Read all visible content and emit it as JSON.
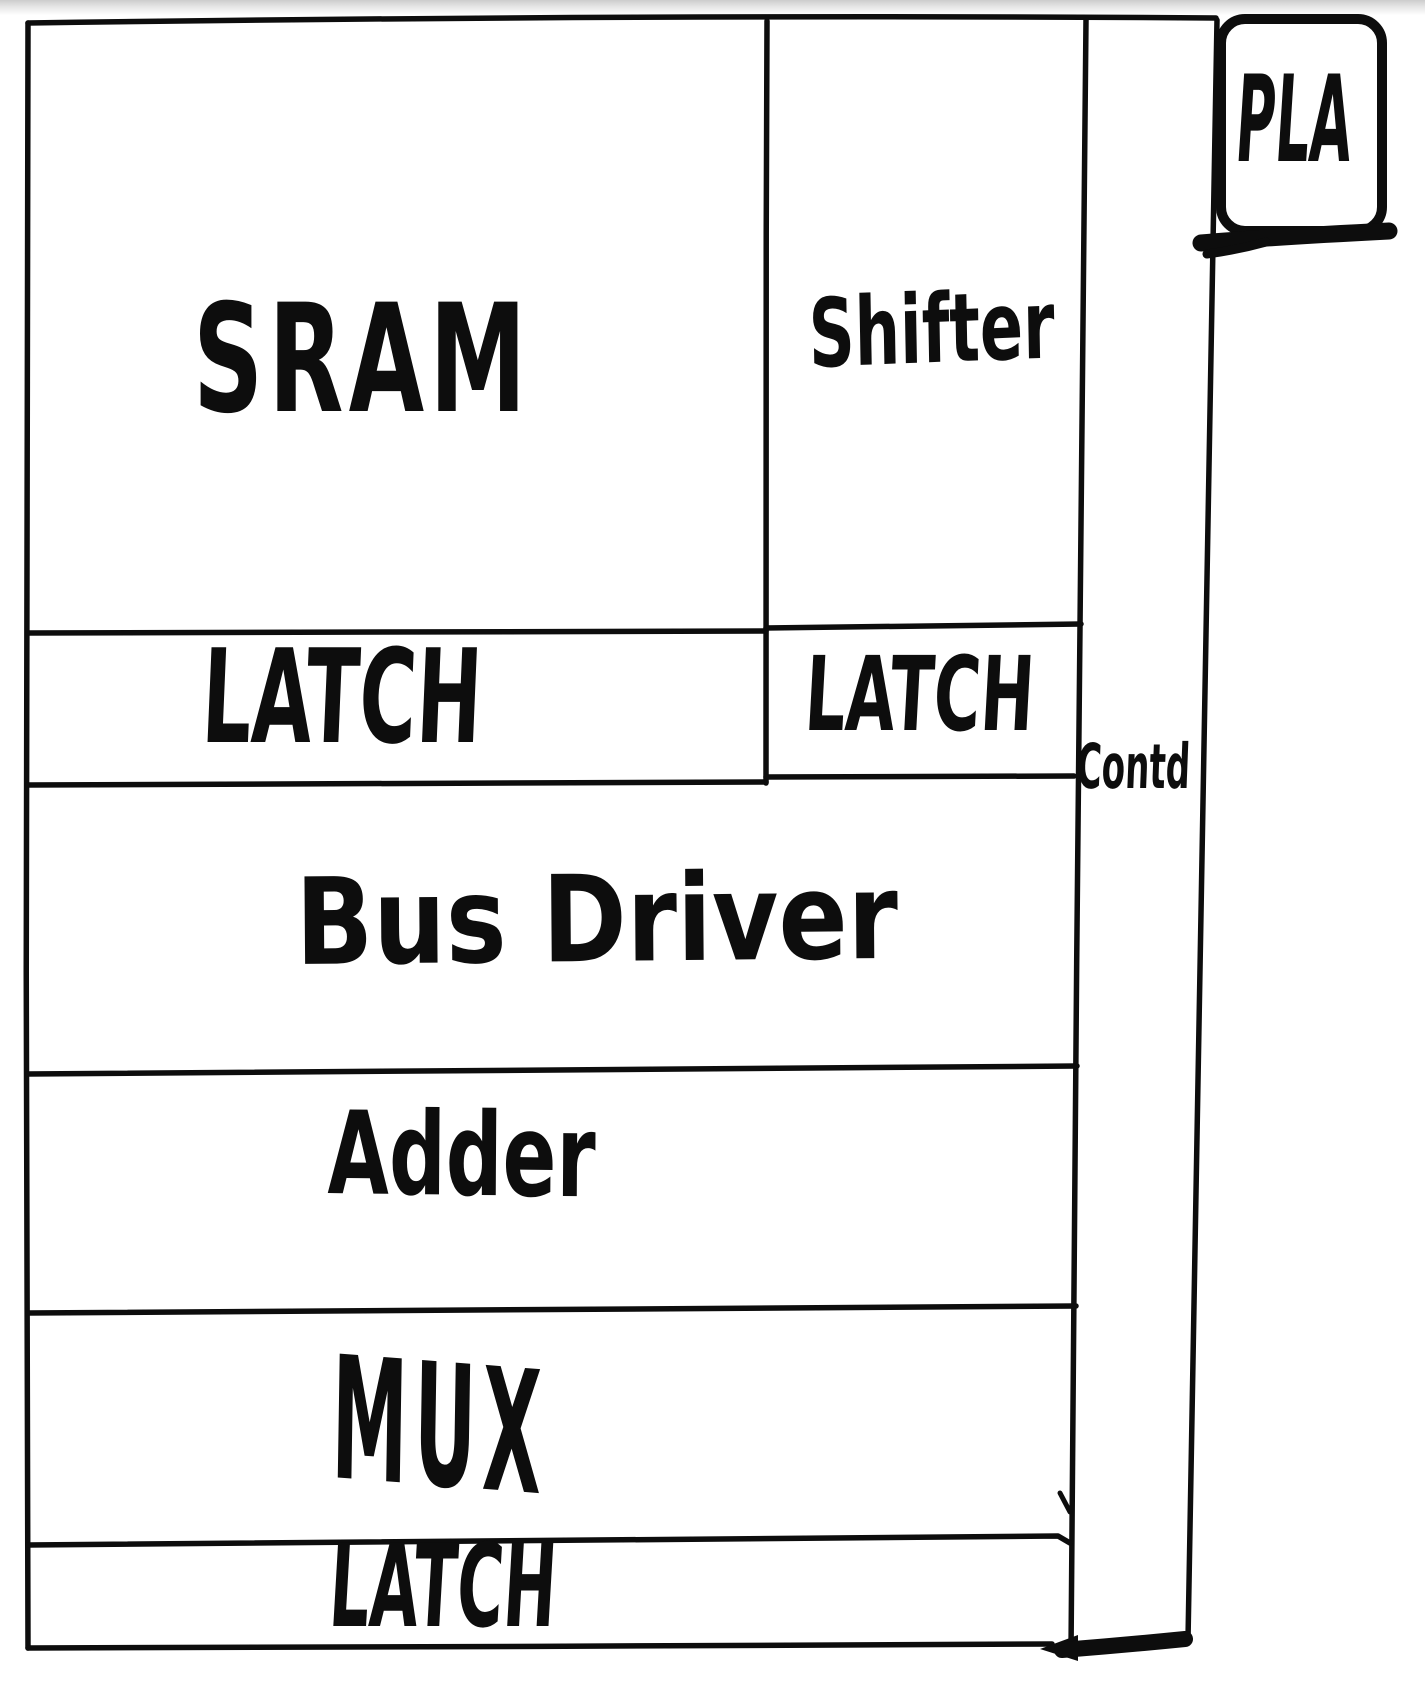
{
  "sketch": {
    "blocks": {
      "sram": {
        "label": "SRAM"
      },
      "shifter": {
        "label": "Shifter"
      },
      "latch_left": {
        "label": "LATCH"
      },
      "latch_right": {
        "label": "LATCH"
      },
      "bus_driver": {
        "label": "Bus Driver"
      },
      "adder": {
        "label": "Adder"
      },
      "mux": {
        "label": "MUX"
      },
      "latch_bottom": {
        "label": "LATCH"
      },
      "control": {
        "label": "Contd"
      },
      "pla": {
        "label": "PLA"
      }
    },
    "ink_color": "#0d0d0d",
    "background_color": "#ffffff"
  }
}
